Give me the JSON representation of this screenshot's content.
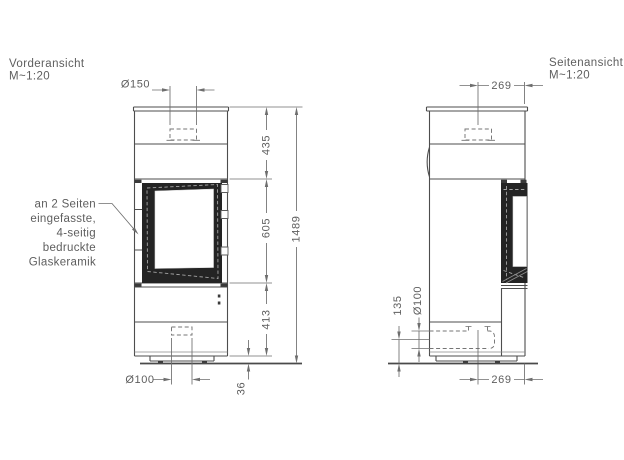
{
  "front_view": {
    "title": "Vorderansicht",
    "scale": "M~1:20",
    "dims": {
      "flue_diameter": "Ø150",
      "upper_height": "435",
      "glass_height": "605",
      "lower_height": "413",
      "total_height": "1489",
      "base_gap": "36",
      "air_inlet_diameter": "Ø100"
    },
    "annotation": {
      "line_1": "an 2 Seiten",
      "line_2": "eingefasste,",
      "line_3": "4-seitig",
      "line_4": "bedruckte",
      "line_5": "Glaskeramik"
    }
  },
  "side_view": {
    "title": "Seitenansicht",
    "scale": "M~1:20",
    "dims": {
      "flue_center_to_front": "269",
      "air_inlet_diameter": "Ø100",
      "air_inlet_center_height": "135",
      "inlet_center_to_front": "269"
    }
  },
  "colors": {
    "line": "#4d4d4d",
    "dimension": "#6e6e6e",
    "text": "#5e5e5e",
    "glass_frame": "#242424",
    "background": "#ffffff"
  }
}
